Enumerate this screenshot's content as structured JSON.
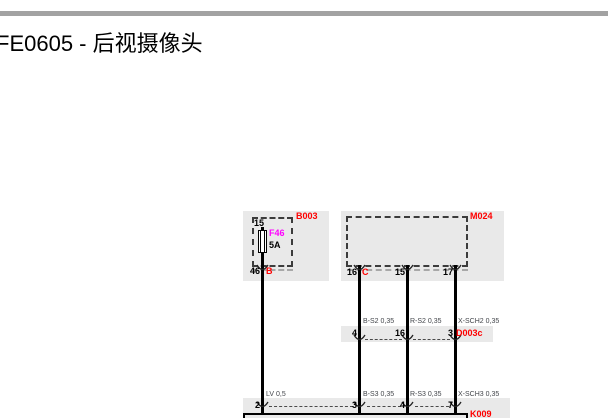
{
  "page": {
    "title": "FE0605 - 后视摄像头"
  },
  "colors": {
    "panel_gray": "#e9e9e9",
    "bar_gray": "#a2a2a2",
    "id_red": "#ff0000",
    "fuse_magenta": "#ff00ff",
    "wire_black": "#000000"
  },
  "diagram": {
    "fusebox": {
      "id": "B003",
      "pin_top": "15",
      "fuse_id": "F46",
      "fuse_rating": "5A",
      "pin_bottom": "46",
      "connector_letter": "B"
    },
    "module": {
      "id": "M024",
      "pin1": "16",
      "pin1_letter": "C",
      "pin2": "15",
      "pin3": "17"
    },
    "inline_connector": {
      "id": "D003c",
      "pin1": "4",
      "pin2": "16",
      "pin3": "3",
      "wire1": "B-S2 0,35",
      "wire2": "R-S2 0,35",
      "wire3": "X-SCH2 0,35"
    },
    "bottom_connector": {
      "id": "K009",
      "pin1": "2",
      "pin2": "3",
      "pin3": "4",
      "pin4": "7",
      "wire1": "LV 0,5",
      "wire2": "B-S3 0,35",
      "wire3": "R-S3 0,35",
      "wire4": "X-SCH3 0,35"
    }
  }
}
